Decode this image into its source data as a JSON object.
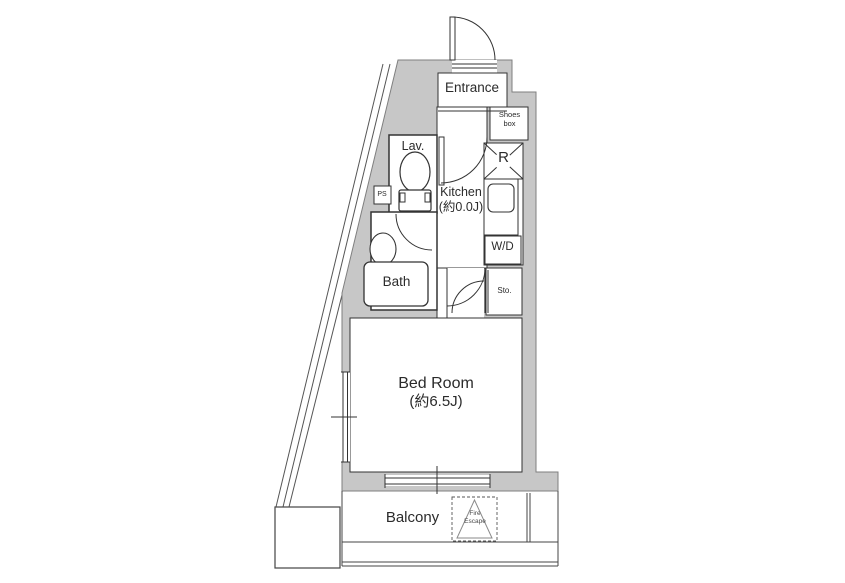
{
  "floor_plan": {
    "title": "apartment-floor-plan",
    "rooms": {
      "entrance": {
        "label": "Entrance"
      },
      "shoes_box": {
        "line1": "Shoes",
        "line2": "box"
      },
      "lav": {
        "label": "Lav."
      },
      "ps": {
        "label": "PS"
      },
      "kitchen": {
        "label": "Kitchen",
        "size": "(約0.0J)"
      },
      "refrigerator": {
        "label": "R"
      },
      "washer_dryer": {
        "label": "W/D"
      },
      "storage": {
        "label": "Sto."
      },
      "bath": {
        "label": "Bath"
      },
      "bedroom": {
        "label": "Bed Room",
        "size": "(約6.5J)"
      },
      "balcony": {
        "label": "Balcony"
      },
      "fire_escape": {
        "line1": "Fire",
        "line2": "Escape"
      }
    },
    "colors": {
      "background": "#ffffff",
      "wall_fill": "#c7c7c7",
      "wall_stroke": "#7f7f7f",
      "line": "#333333"
    }
  }
}
